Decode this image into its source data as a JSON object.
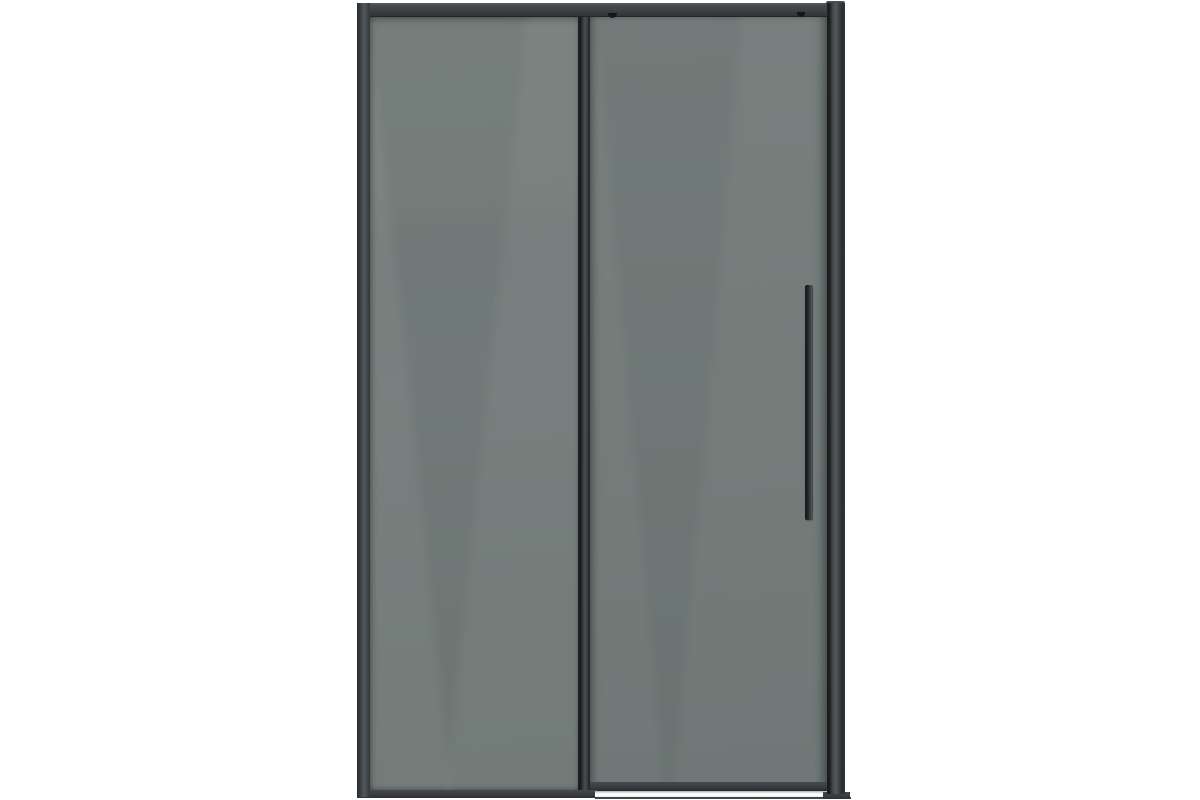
{
  "scene": {
    "description": "Product photo of a sliding shower door: matte black aluminium frame, smoked grey tinted glass, fixed left panel, sliding right panel with a tall thin vertical handle, on a plain white background",
    "orientation": "front view, centered"
  },
  "colors": {
    "background": "#ffffff",
    "frame": "#3e4144",
    "frame-dark": "#232629",
    "frame-light": "#54575a",
    "glass-fixed": "#717a78",
    "glass-sliding": "#6e7775",
    "handle": "#34383b",
    "threshold": "#f8f8f8",
    "floor-rail": "#434648"
  },
  "parts": {
    "frame": [
      "top-rail",
      "top-right-bracket",
      "left-frame-post",
      "right-frame-post",
      "bottom-rail",
      "floor-guide-rail",
      "bottom-right-foot"
    ],
    "panels": [
      "fixed-glass-panel",
      "sliding-glass-panel"
    ],
    "hardware": [
      "door-stile",
      "door-handle",
      "roller-bolt-left",
      "roller-bolt-right",
      "threshold-strip"
    ]
  }
}
